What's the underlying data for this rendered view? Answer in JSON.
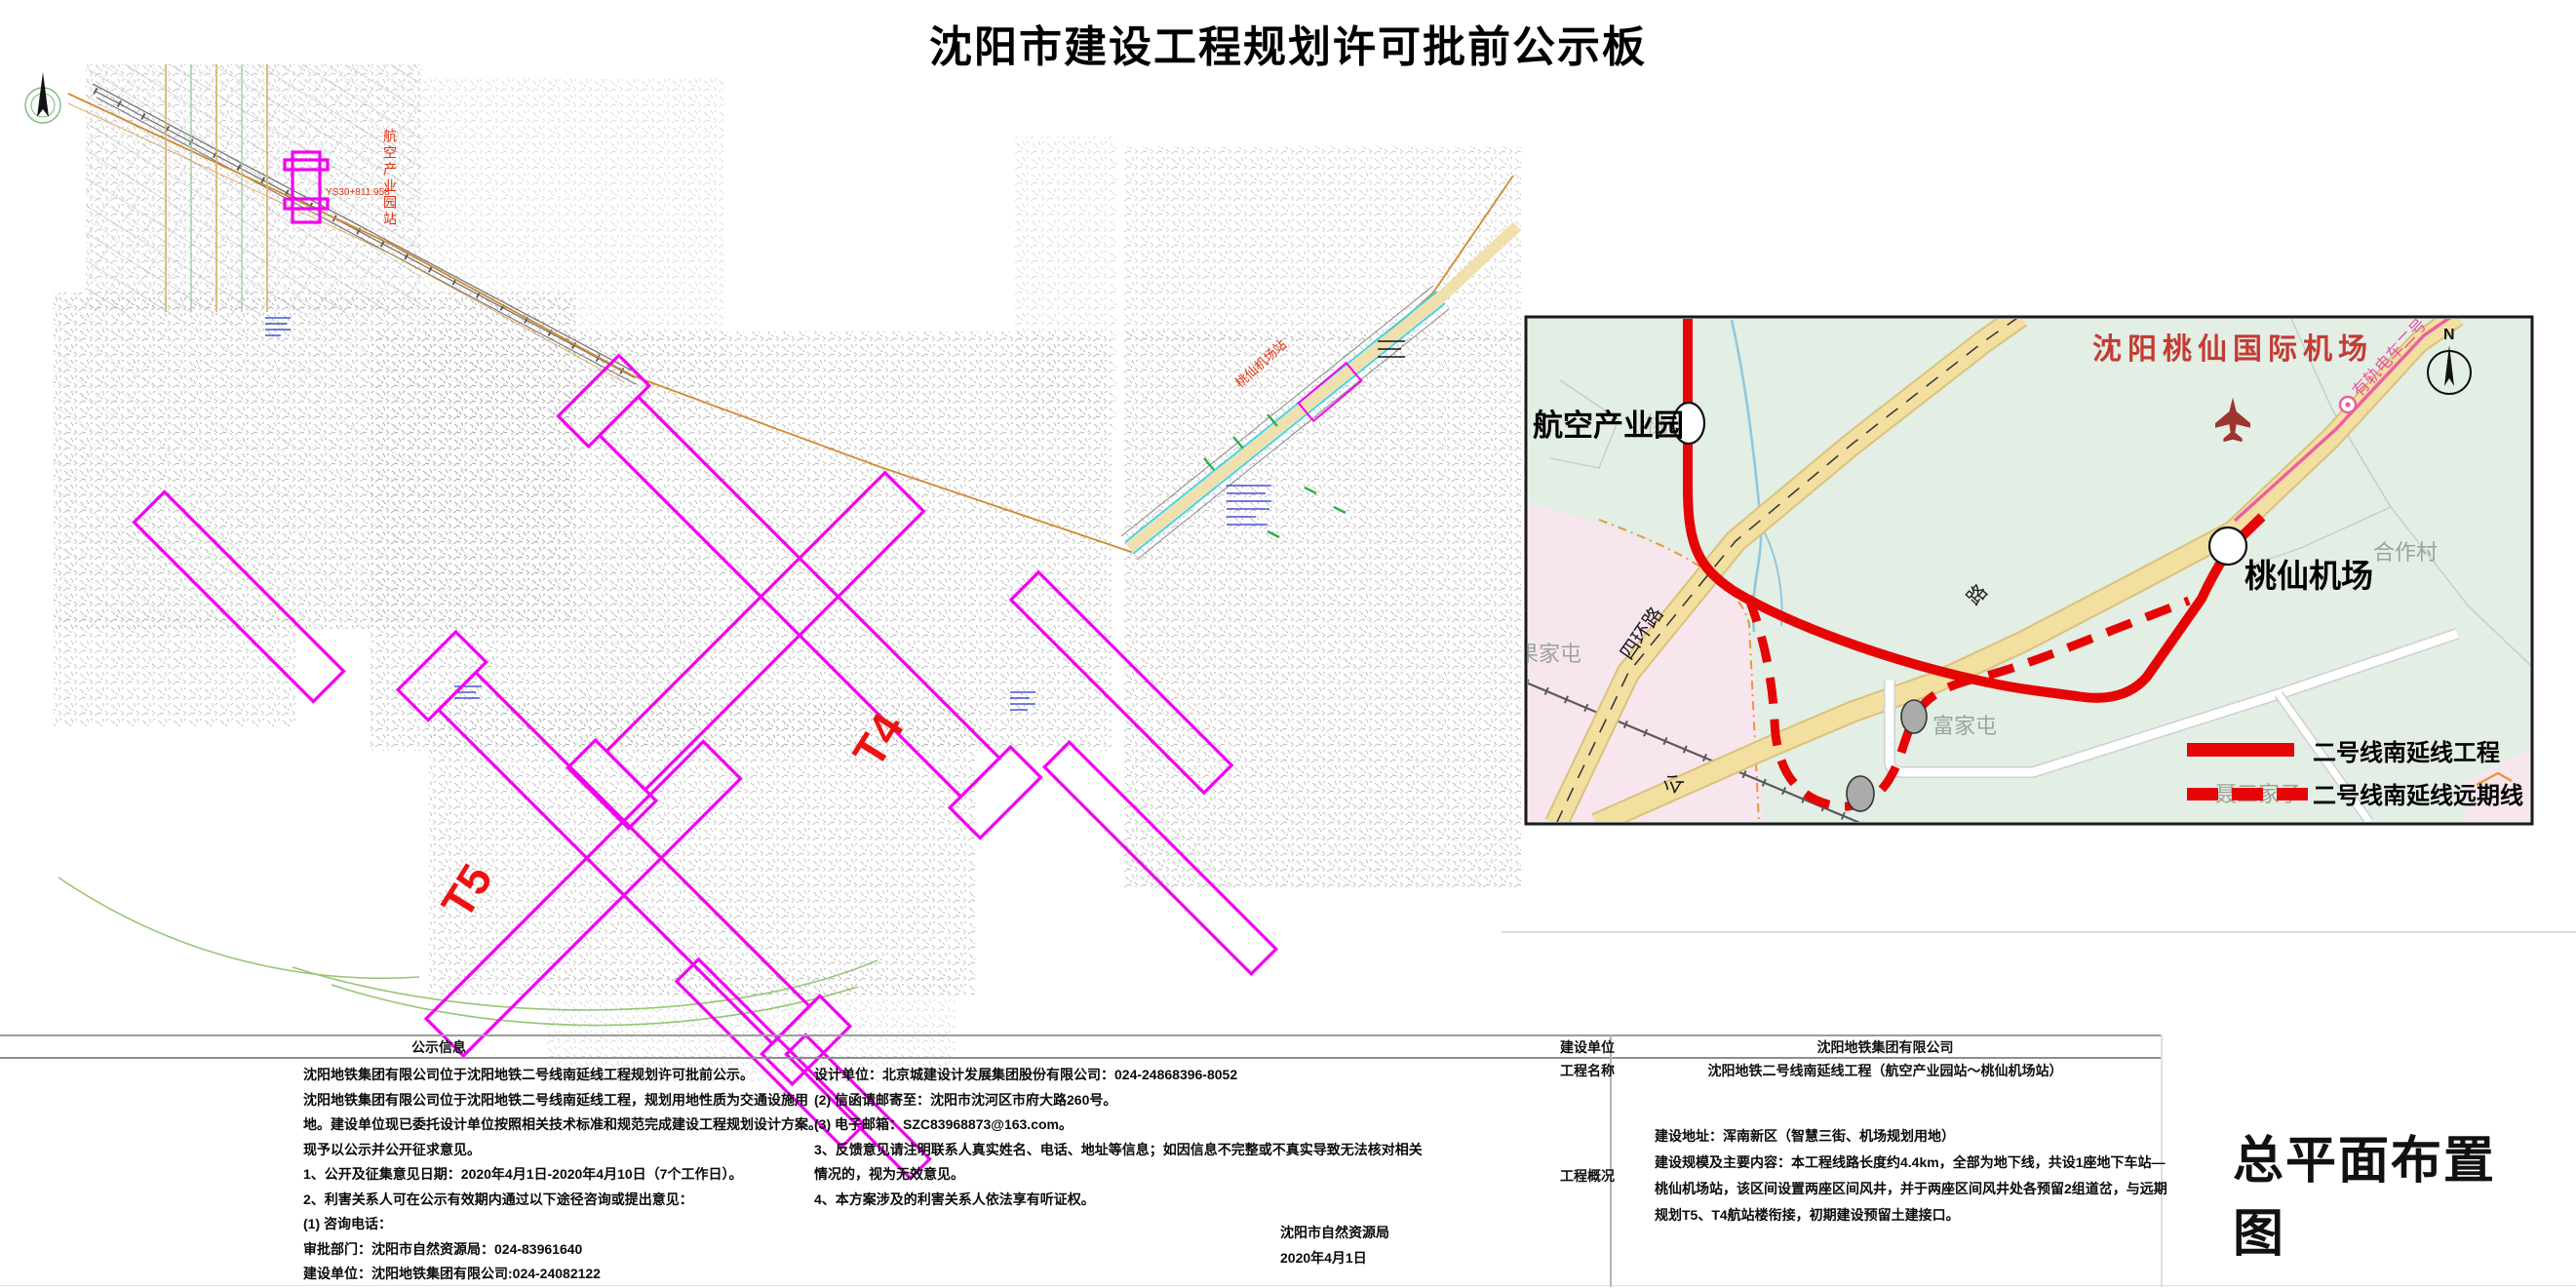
{
  "title": "沈阳市建设工程规划许可批前公示板",
  "drawing_title": "总平面布置图",
  "colors": {
    "metro_red": "#e60505",
    "terminal_magenta": "#f200f2",
    "airport_title_red": "#c43b32",
    "map_green": "#e3eee5",
    "road_yellow": "#f3dfa0",
    "tram_pink": "#e8559d"
  },
  "site_plan": {
    "t4_label": "T4",
    "t5_label": "T5",
    "station_vertical_label": "航空产业园站",
    "chainage_label": "YS30+811.958",
    "taoxian_station_label": "桃仙机场站"
  },
  "inset_map": {
    "airport_title": "沈阳桃仙国际机场",
    "station_hangkong": "航空产业园",
    "station_taoxian": "桃仙机场",
    "road_sihuan": "四环路",
    "road_lu": "路",
    "road_gong": "公",
    "village_hezuo": "合作村",
    "village_fujiatun": "富家屯",
    "village_guojiatun": "果家屯",
    "village_niesanjiazi": "聂三家子",
    "village_taoxian_faint": "桃仙",
    "tram_label": "有轨电车二号",
    "compass_n": "N",
    "legend_solid_label": "二号线南延线工程",
    "legend_dashed_label": "二号线南延线远期线"
  },
  "notice": {
    "header": "公示信息",
    "left_lines": [
      "沈阳地铁集团有限公司位于沈阳地铁二号线南延线工程规划许可批前公示。",
      "沈阳地铁集团有限公司位于沈阳地铁二号线南延线工程，规划用地性质为交通设施用",
      "地。建设单位现已委托设计单位按照相关技术标准和规范完成建设工程规划设计方案。",
      "现予以公示并公开征求意见。",
      "1、公开及征集意见日期：2020年4月1日-2020年4月10日（7个工作日）。",
      "2、利害关系人可在公示有效期内通过以下途径咨询或提出意见：",
      "(1) 咨询电话：",
      "审批部门：沈阳市自然资源局：024-83961640",
      "建设单位：沈阳地铁集团有限公司:024-24082122"
    ],
    "middle_lines": [
      "设计单位：北京城建设计发展集团股份有限公司：024-24868396-8052",
      "(2) 信函请邮寄至：沈阳市沈河区市府大路260号。",
      "(3) 电子邮箱：SZC83968873@163.com。",
      "3、反馈意见请注明联系人真实姓名、电话、地址等信息；如因信息不完整或不真实导致无法核对相关",
      "情况的，视为无效意见。",
      "4、本方案涉及的利害关系人依法享有听证权。"
    ],
    "authority": "沈阳市自然资源局",
    "date": "2020年4月1日"
  },
  "project_table": {
    "row1_label": "建设单位",
    "row1_value": "沈阳地铁集团有限公司",
    "row2_label": "工程名称",
    "row2_value": "沈阳地铁二号线南延线工程（航空产业园站～桃仙机场站）",
    "row3_label": "工程概况",
    "row3_lines": [
      "建设地址：浑南新区（智慧三街、机场规划用地）",
      "建设规模及主要内容：本工程线路长度约4.4km，全部为地下线，共设1座地下车站—",
      "桃仙机场站，该区间设置两座区间风井，并于两座区间风井处各预留2组道岔，与远期",
      "规划T5、T4航站楼衔接，初期建设预留土建接口。"
    ]
  }
}
